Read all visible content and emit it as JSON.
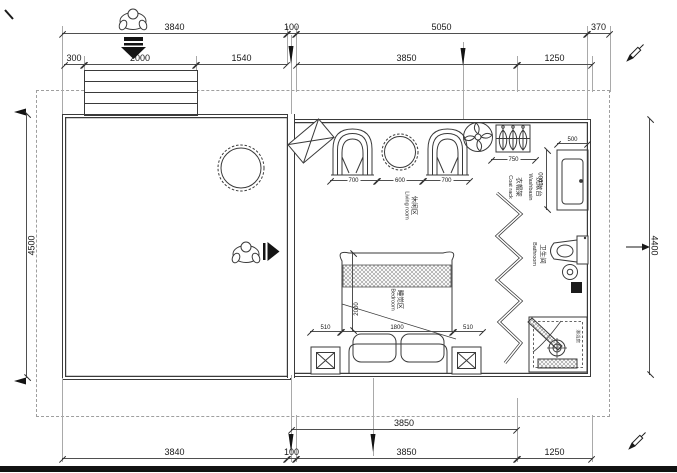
{
  "colors": {
    "line": "#3a3a3a",
    "dim": "#4f4f4f",
    "light": "#a9a9a9",
    "black": "#141414",
    "bg": "#ffffff"
  },
  "dims": {
    "top_row1": [
      "3840",
      "100",
      "5050",
      "370"
    ],
    "top_row2": [
      "300",
      "2000",
      "1540",
      "3850",
      "1250"
    ],
    "left_height": "4500",
    "right_height": "4400",
    "bottom_row1": "3850",
    "bottom_row2": [
      "3840",
      "100",
      "3850",
      "1250"
    ],
    "seating": [
      "700",
      "600",
      "700"
    ],
    "coat_rack_width": "750",
    "washbasin_width": "500",
    "washbasin_length": "1000",
    "bed_row": [
      "510",
      "1800",
      "510"
    ],
    "bed_length": "2000"
  },
  "rooms": {
    "living": {
      "zh": "休闲区",
      "en": "Living room"
    },
    "sleeping": {
      "zh": "睡觉区",
      "en": "Bedroom"
    },
    "coat_rack": {
      "zh": "衣帽架",
      "en": "Coat rack"
    },
    "washbasin": {
      "zh": "洗漱台",
      "en": "Washbasin"
    },
    "bathroom": {
      "zh": "卫生间",
      "en": "Bathroom"
    },
    "shower": {
      "zh": "淋浴房"
    }
  },
  "icons": [
    "person-top-view-icon",
    "entry-arrow-icon",
    "walk-arrow-icon",
    "ceiling-fan-icon",
    "hanger-icon",
    "pen-icon",
    "section-arrow-icon",
    "leader-arrow-icon"
  ]
}
